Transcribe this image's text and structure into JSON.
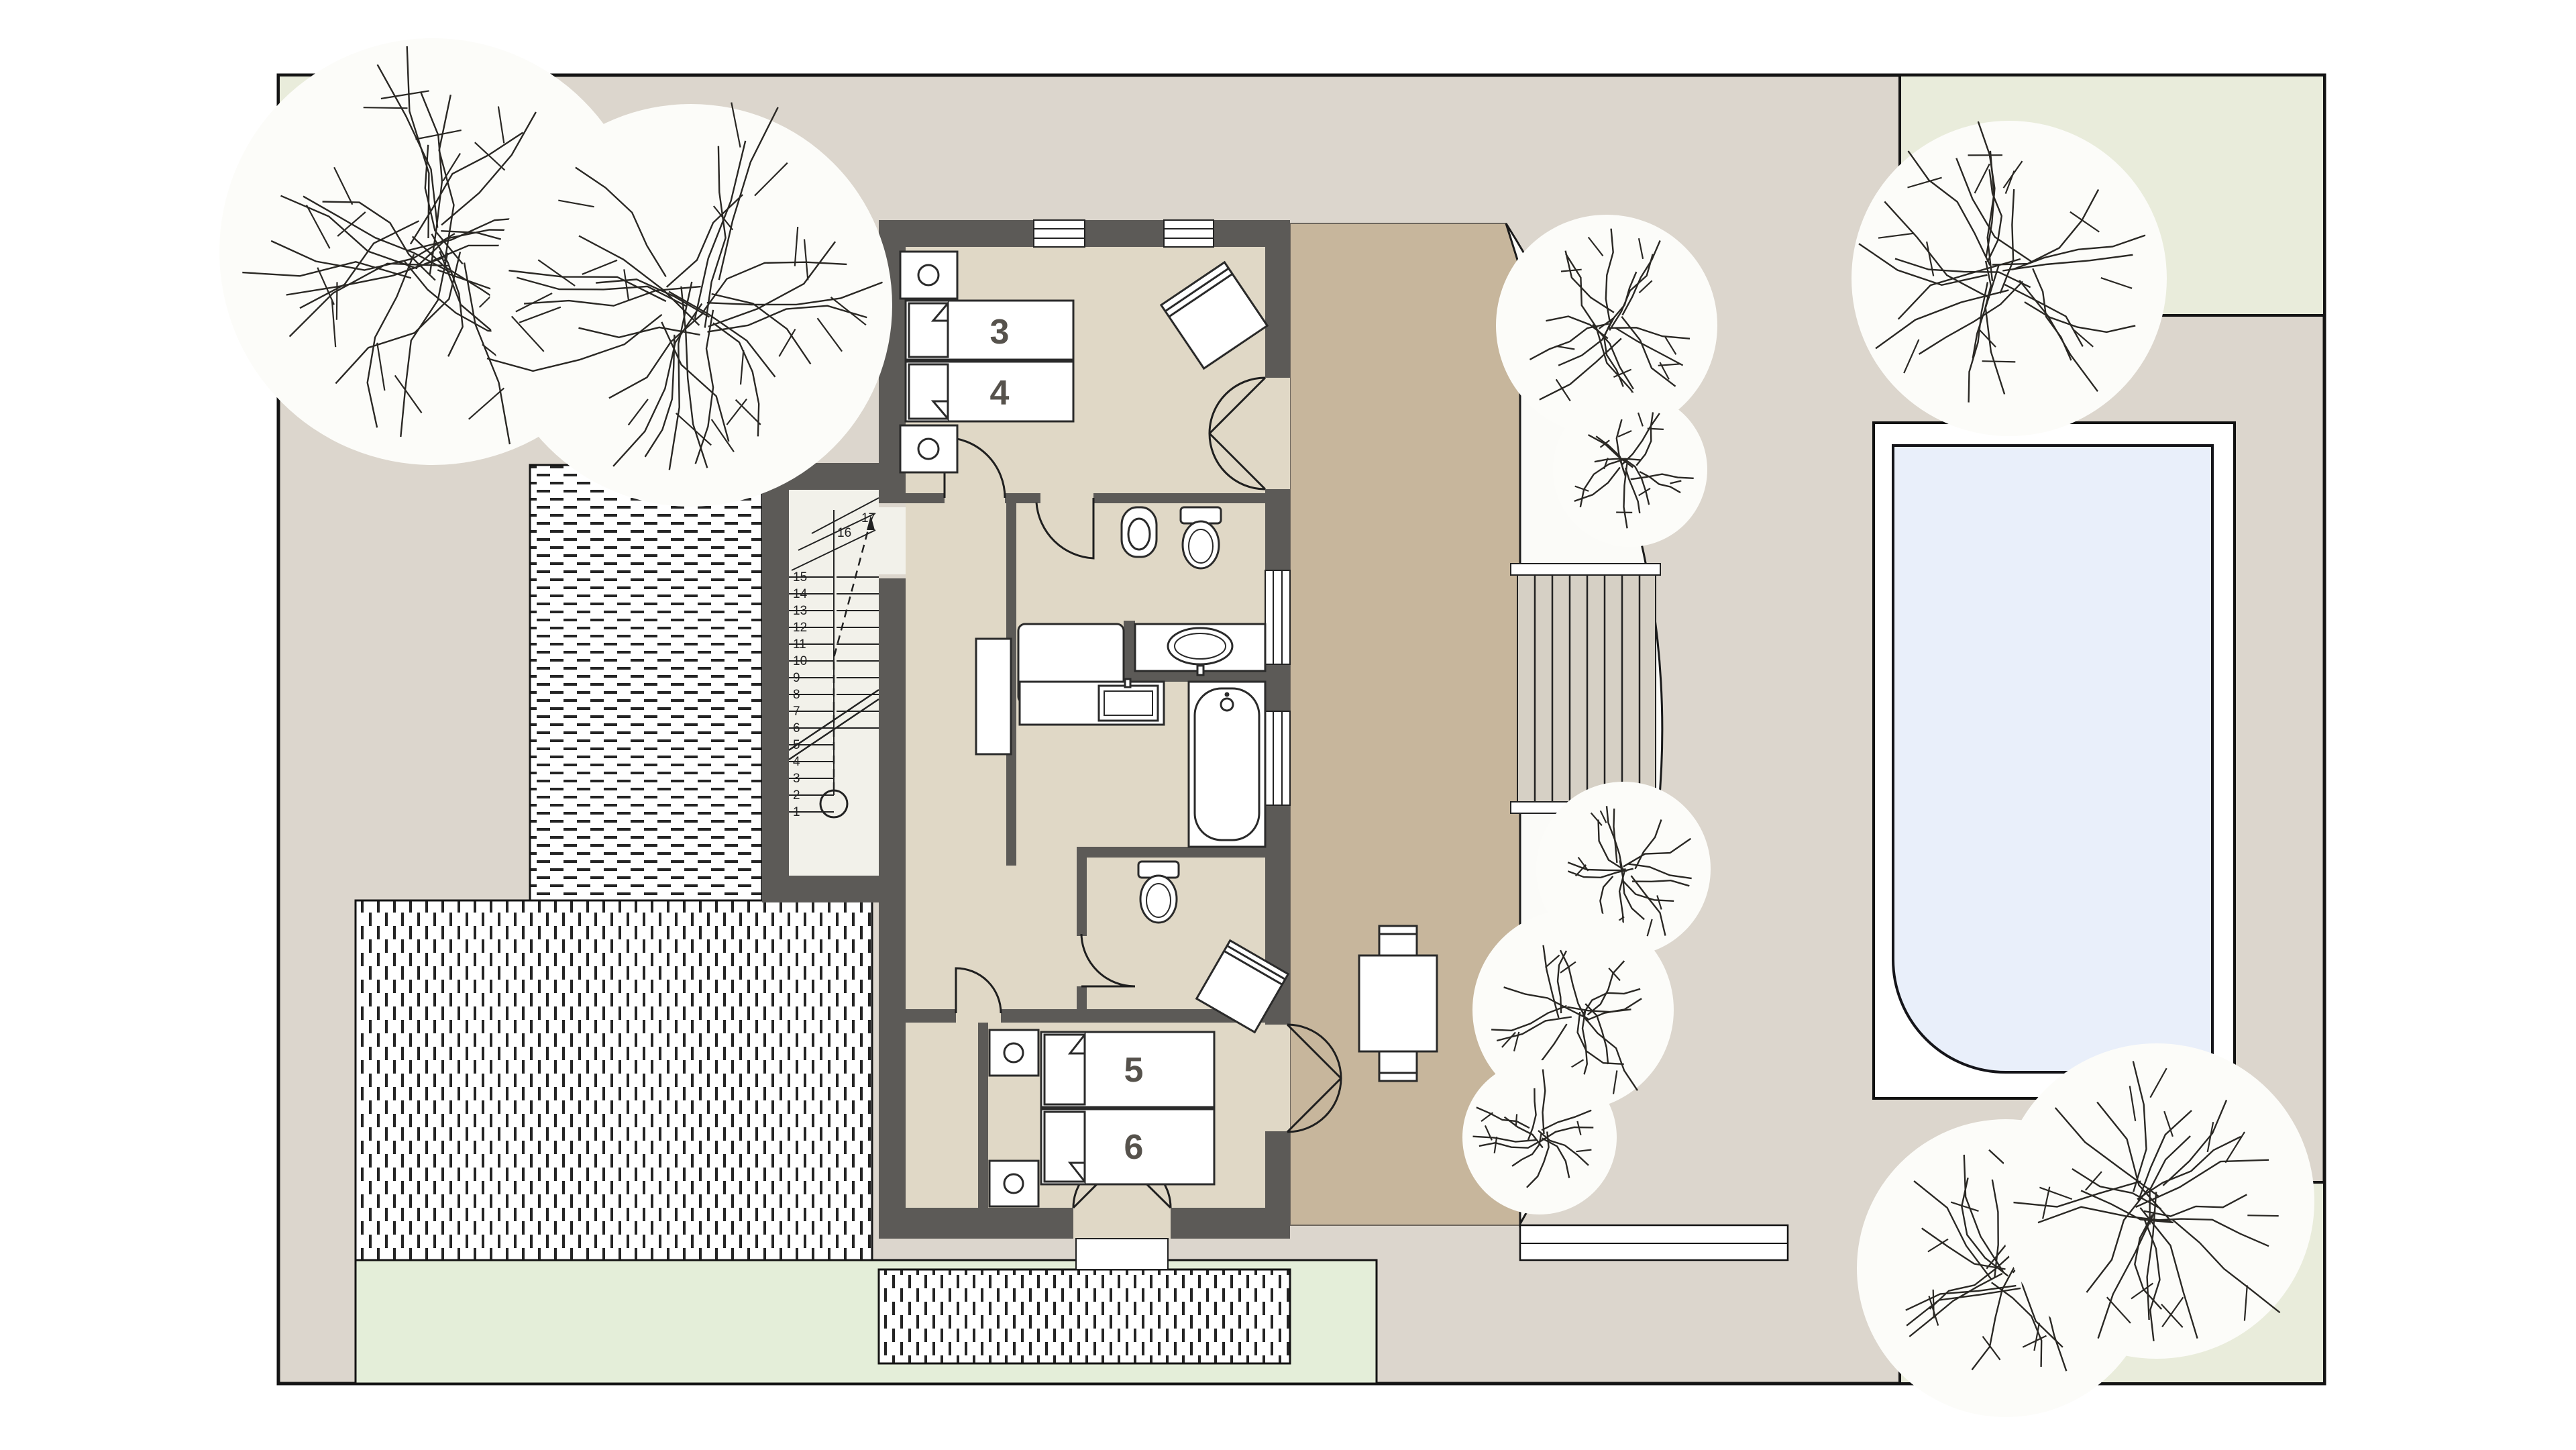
{
  "plan": {
    "type": "architectural-floor-plan",
    "level_features": [
      "bedrooms",
      "bathroom",
      "wc",
      "stair",
      "roof-terrace",
      "pool",
      "garden"
    ]
  },
  "beds": {
    "bed3": "3",
    "bed4": "4",
    "bed5": "5",
    "bed6": "6"
  },
  "stairs": {
    "steps": [
      "1",
      "2",
      "3",
      "4",
      "5",
      "6",
      "7",
      "8",
      "9",
      "10",
      "11",
      "12",
      "13",
      "14",
      "15",
      "16",
      "17"
    ]
  },
  "colors": {
    "site_background": "#dcd6cd",
    "garden_green": "#e9ecdb",
    "lawn_green": "#e4eed9",
    "room_floor": "#e0d8c6",
    "terrace_tan": "#c7b69c",
    "wall_gray": "#5c5a57",
    "pool_water": "#e9effa",
    "line_black": "#1a1a1a",
    "fixture_white": "#ffffff"
  }
}
